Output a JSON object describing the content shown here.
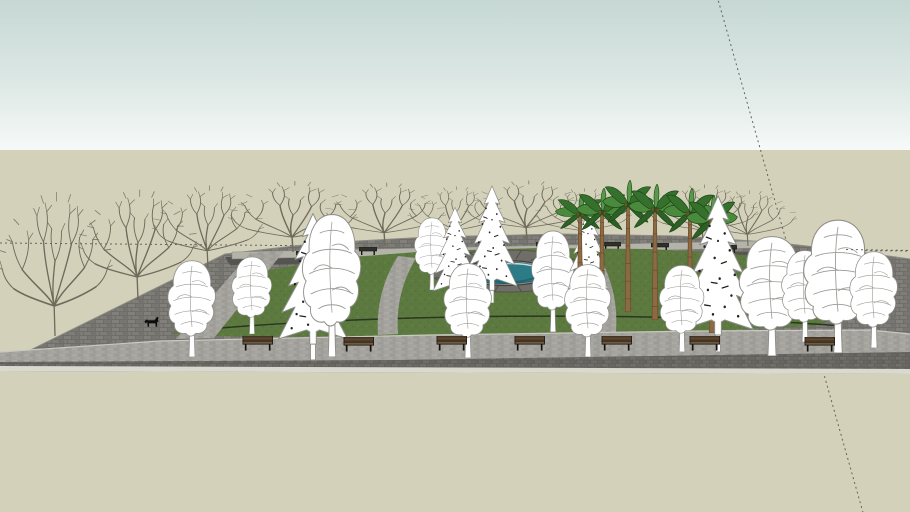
{
  "meta": {
    "app": "sketchup-style-park-model-viewport",
    "canvas": {
      "width": 910,
      "height": 512
    },
    "scene_label": "3D park model with trees, benches and pond"
  },
  "scene": {
    "horizon_y": 150,
    "colors": {
      "sky_top": "#c6d8d4",
      "sky_mid": "#dde8e5",
      "sky_bottom": "#f7faf9",
      "ground": "#d4d1ba",
      "guide": "#63635e",
      "cobble_base": "#7b7974",
      "cobble_dark": "#6e6c66",
      "path_base": "#a3a29c",
      "curb": "#dad9d0",
      "curb_line": "#c9c8c1",
      "grass": "#5c7a3f",
      "grass_dark": "#52703a",
      "hedge": "#2a3620",
      "back_band": "#565450",
      "back_wall": "#b4b3aa",
      "plaza": "#6f6e68",
      "plaza_joint": "#504e49",
      "water": "#2e7b88",
      "water_dark": "#1f5f6b",
      "water_light": "#cfeaec",
      "tree_outline": "#8f8f8b",
      "tree_vein": "#9b9b97",
      "bare_branch": "#6f6a5c",
      "conifer_speckle": "#21211e",
      "palm_trunk": "#8c6a44",
      "palm_trunk_line": "#6b4c2c",
      "bench_wood": "#5f4a33",
      "bench_seat": "#6f5940",
      "bench_frame": "#15120e",
      "dog": "#0e0d0b"
    },
    "guide_lines": [
      {
        "x1": 0,
        "y1": 243,
        "x2": 910,
        "y2": 251,
        "layer": "back"
      },
      {
        "x1": 717,
        "y1": -4,
        "x2": 864,
        "y2": 516,
        "layer": "back"
      },
      {
        "x1": 846,
        "y1": 249.5,
        "x2": 910,
        "y2": 250.5,
        "layer": "front"
      }
    ],
    "platform": {
      "points": "0,365 225,254 320,243 430,237 560,234 680,236 780,243 860,252 910,259 910,374 0,371"
    },
    "back_wall": {
      "points": "232,252 758,241 758,248 232,259"
    },
    "back_band": {
      "points": "225,257 860,251 868,259 230,265"
    },
    "grass": {
      "points": "172,334 210,300 268,270 340,258 430,251 540,248 650,249 745,255 808,263 845,274 858,288 858,302 842,316 815,326 700,331 540,334 380,336 250,337",
      "hedge_path": "M178,332 C360,313 660,311 842,326"
    },
    "plaza": {
      "cx": 508,
      "cy": 271,
      "rx": 78,
      "ry": 21,
      "joints": 18
    },
    "pond": {
      "cx": 505,
      "cy": 273,
      "rx": 43,
      "ry": 10.5
    },
    "walkways": {
      "left_diag": "250,253 284,251 214,338 176,339",
      "curve_left": "M416,258 C402,282 396,306 398,334 L378,335 C376,304 384,278 398,256 Z",
      "curve_right": "M600,257 C612,280 618,304 616,332 L598,333 C602,304 596,280 586,257 Z",
      "front_band": "0,352 160,341 430,335 700,331 870,330 910,334 910,352 400,360 0,362",
      "front_dark": "0,362 400,360 910,352 910,370 0,368",
      "curb_strip": "0,366 910,369 910,374 0,371",
      "curb_line_path": "M0,352 L160,341 L430,335 L700,331 L870,330 L910,334"
    },
    "trees": {
      "bare": [
        [
          55,
          336,
          115,
          150
        ],
        [
          138,
          300,
          120,
          115
        ],
        [
          208,
          268,
          112,
          86
        ],
        [
          293,
          252,
          130,
          74
        ],
        [
          385,
          246,
          122,
          66
        ],
        [
          455,
          242,
          95,
          58
        ],
        [
          527,
          240,
          126,
          62
        ],
        [
          583,
          242,
          98,
          56
        ],
        [
          703,
          242,
          112,
          60
        ],
        [
          748,
          246,
          98,
          58
        ]
      ],
      "white_mid": [
        [
          252,
          334,
          52,
          80
        ],
        [
          432,
          290,
          45,
          75
        ],
        [
          553,
          332,
          55,
          105
        ]
      ],
      "conifer_back": [
        [
          455,
          305,
          52,
          100
        ],
        [
          492,
          303,
          60,
          120
        ],
        [
          588,
          303,
          48,
          100
        ]
      ],
      "palm": [
        [
          580,
          302,
          60,
          108
        ],
        [
          602,
          318,
          62,
          130
        ],
        [
          628,
          312,
          62,
          132
        ],
        [
          655,
          320,
          64,
          136
        ],
        [
          690,
          326,
          64,
          138
        ],
        [
          712,
          333,
          62,
          138
        ]
      ],
      "white_front": [
        [
          192,
          357,
          62,
          100
        ],
        [
          332,
          357,
          76,
          148
        ],
        [
          468,
          358,
          62,
          98
        ],
        [
          588,
          357,
          60,
          96
        ],
        [
          682,
          352,
          58,
          90
        ],
        [
          772,
          356,
          84,
          124
        ],
        [
          805,
          342,
          60,
          95
        ],
        [
          838,
          353,
          88,
          138
        ],
        [
          874,
          348,
          62,
          100
        ]
      ],
      "conifer_front": [
        [
          313,
          360,
          82,
          150
        ],
        [
          718,
          352,
          84,
          160
        ]
      ]
    },
    "benches": {
      "front": [
        [
          258,
          351
        ],
        [
          359,
          352
        ],
        [
          452,
          351
        ],
        [
          530,
          351
        ],
        [
          617,
          351
        ],
        [
          705,
          351
        ],
        [
          820,
          352
        ]
      ],
      "back": [
        [
          305,
          259
        ],
        [
          368,
          255
        ],
        [
          452,
          252
        ],
        [
          545,
          250
        ],
        [
          612,
          250
        ],
        [
          660,
          251
        ],
        [
          728,
          253
        ]
      ]
    },
    "dog": {
      "x": 152,
      "y": 328
    }
  }
}
